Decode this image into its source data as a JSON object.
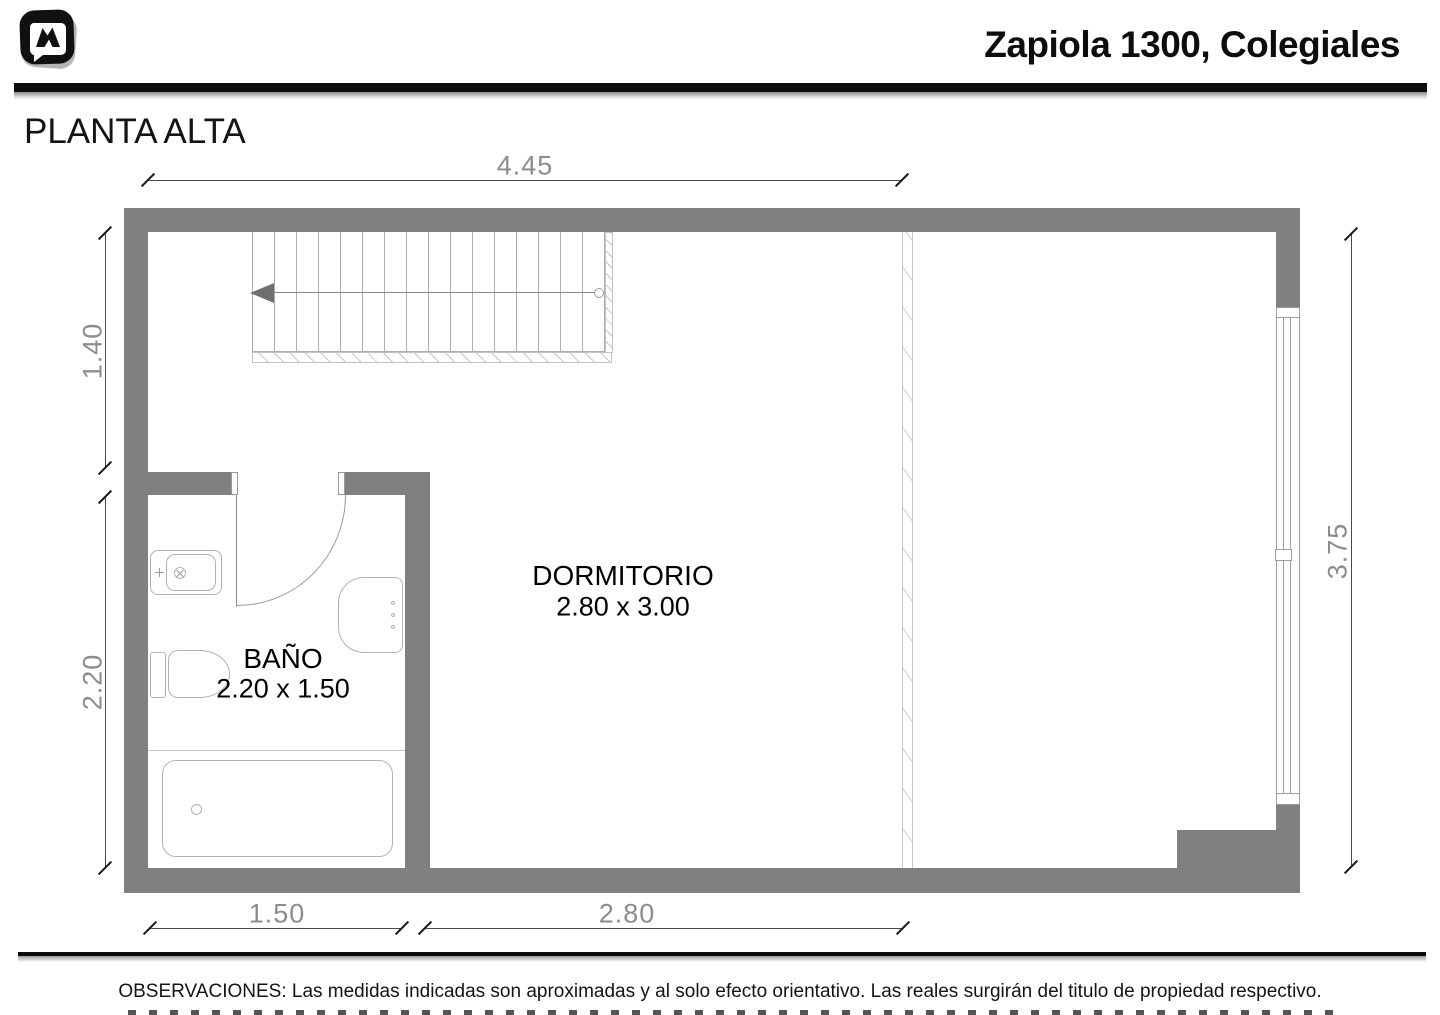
{
  "header": {
    "title": "Zapiola 1300, Colegiales"
  },
  "plan": {
    "floor_label": "PLANTA ALTA",
    "rooms": {
      "dormitorio": {
        "name": "DORMITORIO",
        "size": "2.80 x 3.00"
      },
      "bano": {
        "name": "BAÑO",
        "size": "2.20 x 1.50"
      }
    },
    "dims": {
      "top_width": "4.45",
      "stair_zone_depth": "1.40",
      "bath_depth": "2.20",
      "interior_depth": "3.75",
      "bath_width": "1.50",
      "dorm_width": "2.80"
    }
  },
  "icons": {
    "logo": "brand-logo-speech-bubble-m",
    "stair_arrow": "stair-direction-arrow-left"
  },
  "footer": {
    "observations": "OBSERVACIONES: Las medidas indicadas son aproximadas y al solo efecto orientativo. Las reales surgirán del titulo de propiedad respectivo."
  },
  "colors": {
    "wall": "#808080",
    "dim_text": "#8c8c8c",
    "rule_black": "#0c0c0c"
  }
}
